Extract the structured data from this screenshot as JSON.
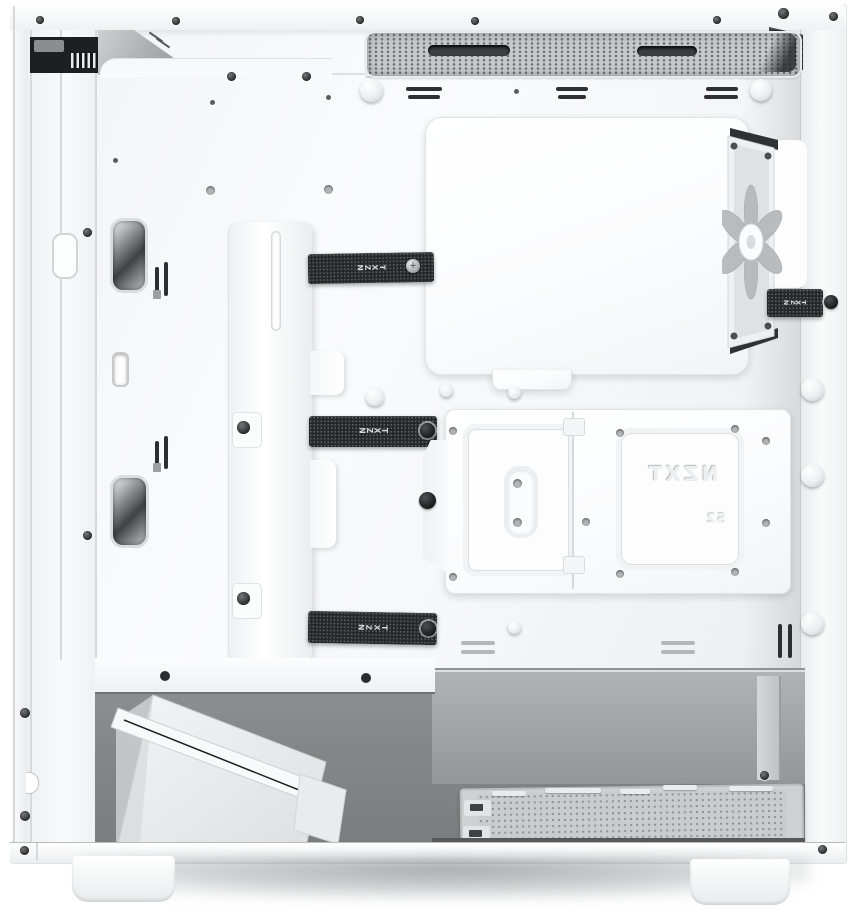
{
  "image": {
    "kind": "product-photo",
    "subject": "White mid-tower PC case interior, side panel removed, cable-management side view",
    "background": "#ffffff"
  },
  "brand": "NZXT",
  "text": {
    "strap_top": "NZXT",
    "strap_middle": "NZXT",
    "strap_bottom": "NZXT",
    "strap_rear": "NZXT",
    "embossed_logo": "NZXT",
    "embossed_mark": "S2"
  },
  "colors": {
    "case_white": "#fafbfc",
    "panel_line": "#d9dcde",
    "mesh_gray": "#c6c9cb",
    "strap_black": "#26282b",
    "chamber_gray": "#868889",
    "floor_gray": "#c9cbcc",
    "fan_blade_gray": "#b4b7ba",
    "fastener_dark": "#2c2f32"
  },
  "parts": [
    {
      "name": "top-exhaust-vent"
    },
    {
      "name": "front-io-cables"
    },
    {
      "name": "top-panel-bracket"
    },
    {
      "name": "motherboard-tray"
    },
    {
      "name": "cpu-cutout-cover"
    },
    {
      "name": "rear-exhaust-fan"
    },
    {
      "name": "cable-straps"
    },
    {
      "name": "cable-channel"
    },
    {
      "name": "drive-bracket"
    },
    {
      "name": "thumbscrew"
    },
    {
      "name": "psu-chamber"
    },
    {
      "name": "bottom-fan-duct"
    },
    {
      "name": "psu-vent-floor"
    },
    {
      "name": "case-feet"
    }
  ]
}
